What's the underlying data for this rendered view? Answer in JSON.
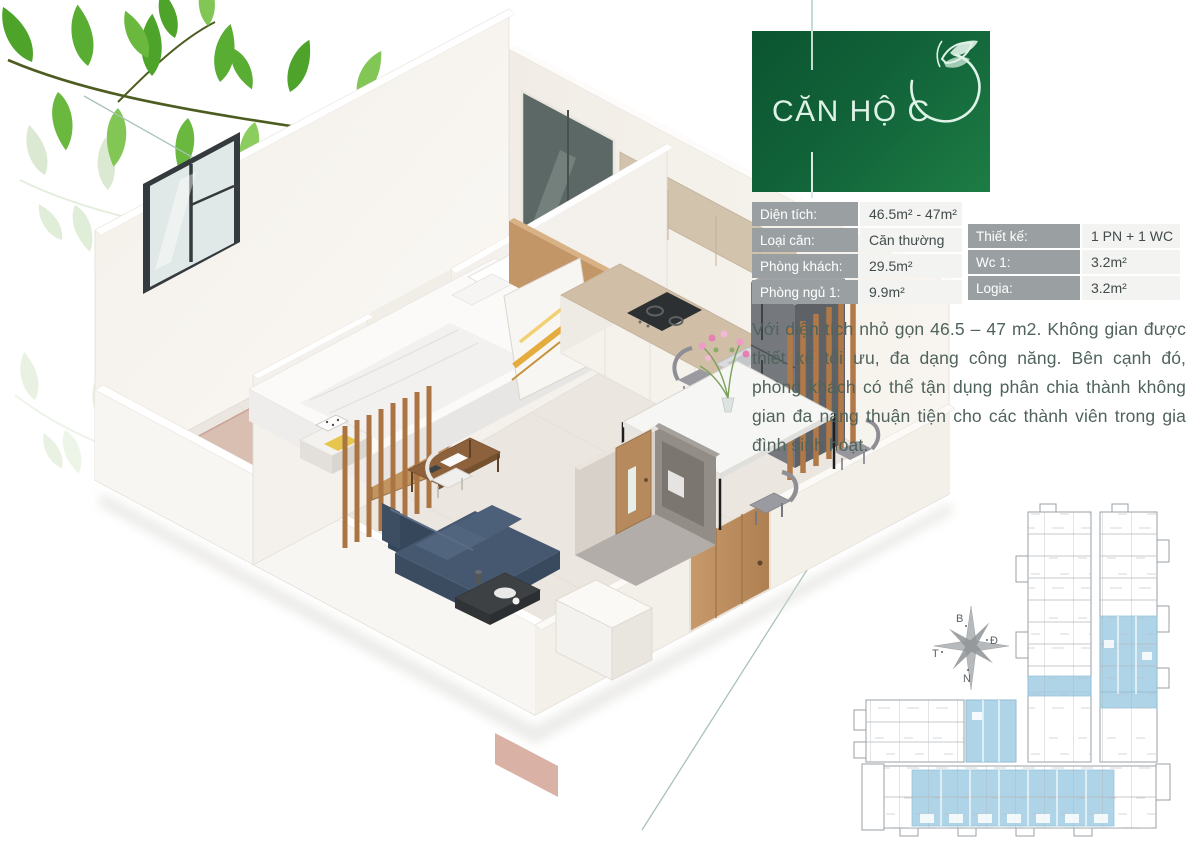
{
  "badge": {
    "title": "CĂN HỘ C"
  },
  "specs": {
    "left": [
      {
        "label": "Diện tích:",
        "value": "46.5m² - 47m²"
      },
      {
        "label": "Loại căn:",
        "value": "Căn thường"
      },
      {
        "label": "Phòng khách:",
        "value": "29.5m²"
      },
      {
        "label": "Phòng ngủ 1:",
        "value": "9.9m²"
      }
    ],
    "right": [
      {
        "label": "Thiết kế:",
        "value": "1 PN + 1 WC"
      },
      {
        "label": "Wc 1:",
        "value": "3.2m²"
      },
      {
        "label": "Logia:",
        "value": "3.2m²"
      }
    ]
  },
  "description": "Với diện tích nhỏ gọn 46.5 – 47 m2. Không gian được thiết kế tối ưu, đa dạng công năng. Bên cạnh đó, phòng khách có thể tận dụng phân chia thành không gian đa năng thuận tiện cho các thành viên trong gia đình sinh hoạt.",
  "compass": {
    "north": "B",
    "east": "Đ",
    "west": "T",
    "south": "N"
  },
  "colors": {
    "badge_green_dark": "#0b5530",
    "badge_green_light": "#1d7c44",
    "table_label_bg": "#9aa0a2",
    "highlight_blue": "#a9d1e6",
    "body_text": "#50635d",
    "leaf_green": "#4ea32b"
  }
}
